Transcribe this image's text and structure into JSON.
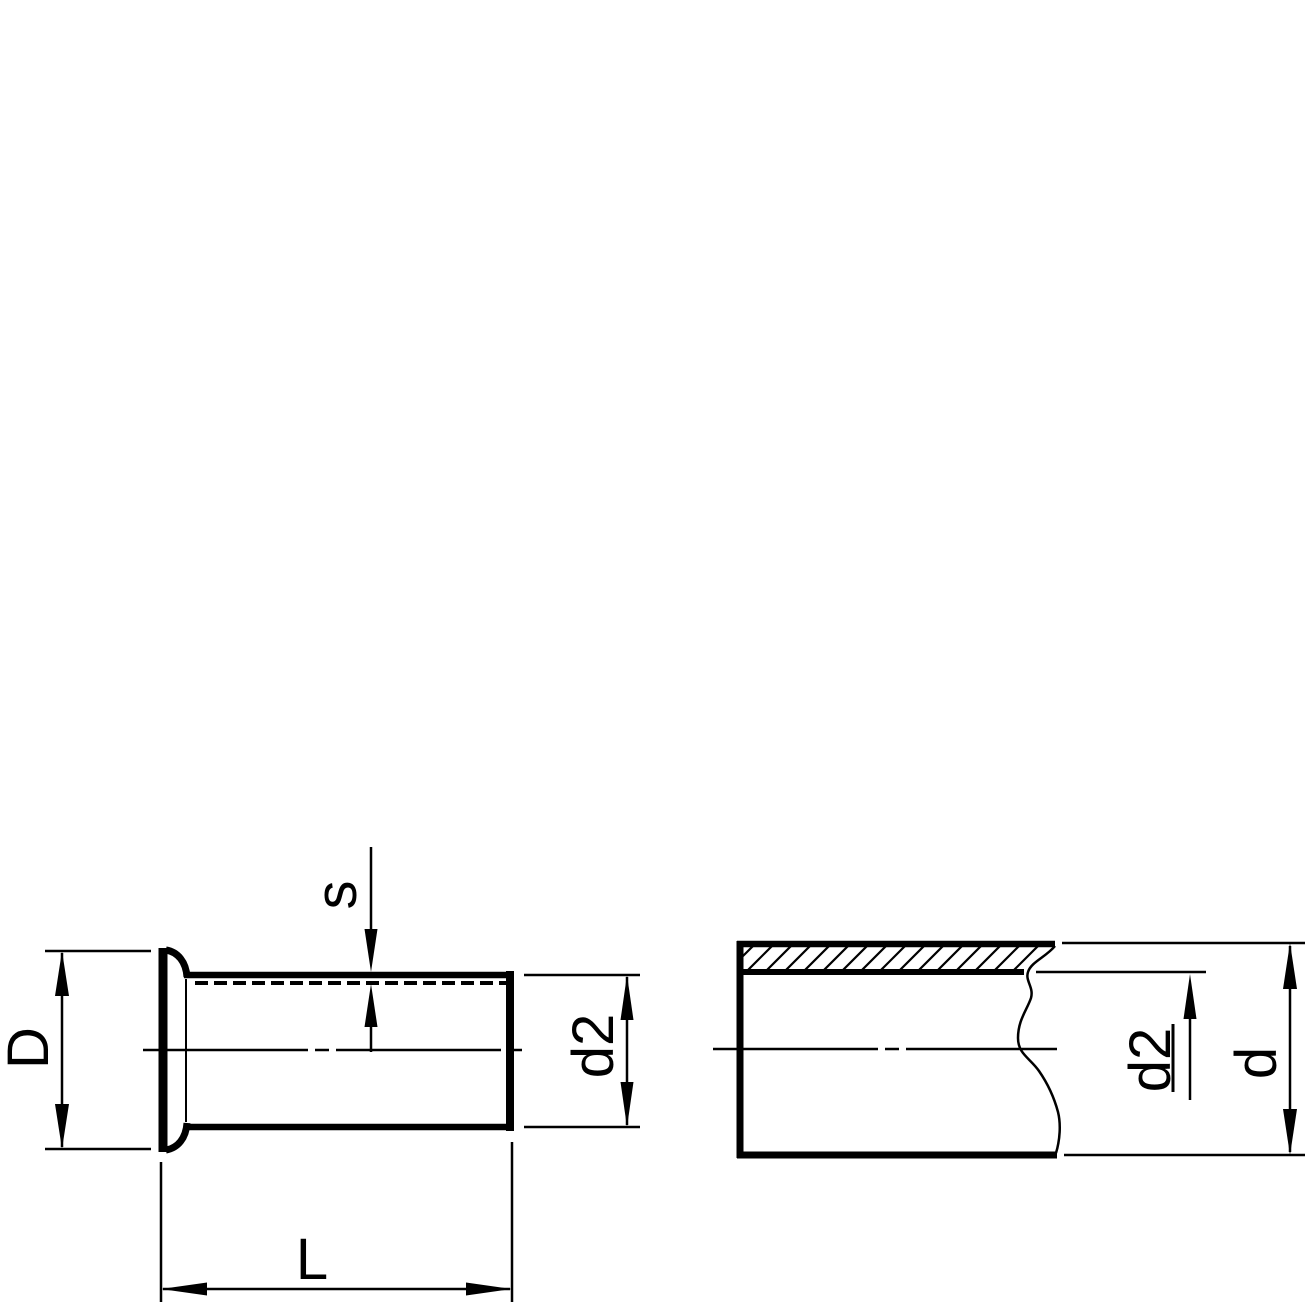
{
  "drawing": {
    "background_color": "#ffffff",
    "line_color": "#000000",
    "side_view": {
      "labels": {
        "flange_diameter": "D",
        "wall_thickness": "s",
        "sleeve_outer_diameter": "d2",
        "sleeve_length": "L"
      }
    },
    "section_view": {
      "labels": {
        "inner_diameter": "d2",
        "outer_diameter": "d"
      }
    }
  }
}
